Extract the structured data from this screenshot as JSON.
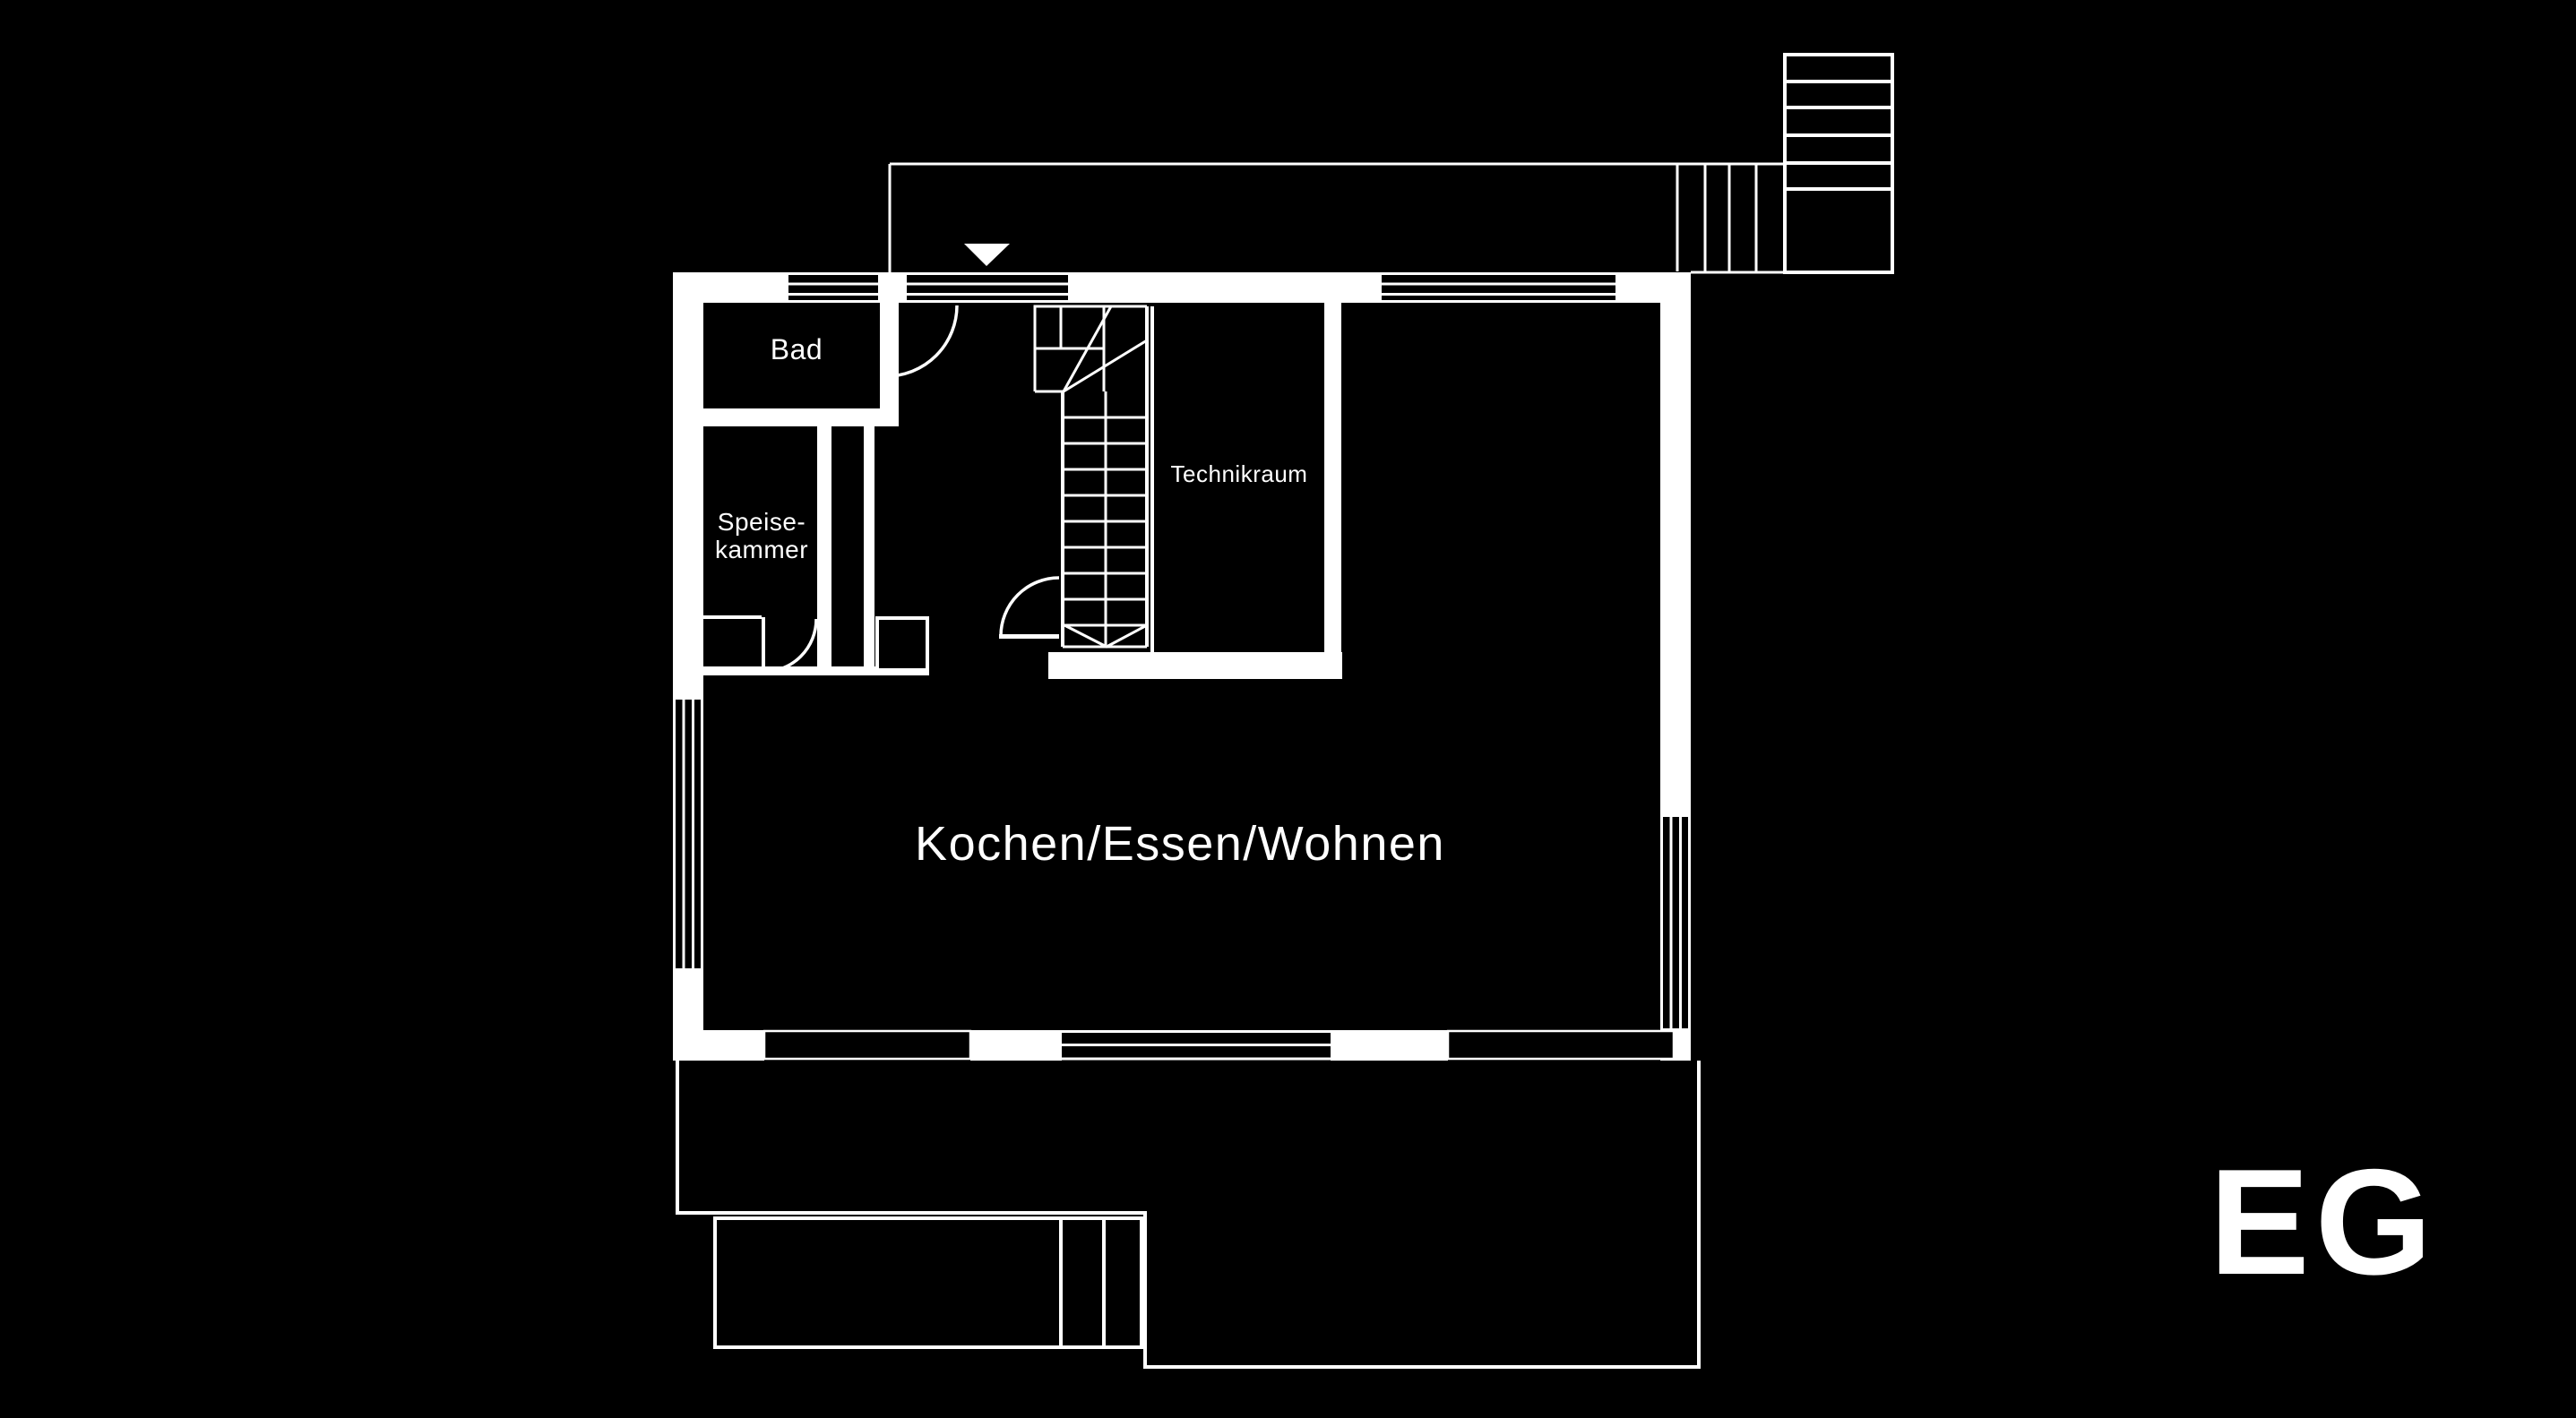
{
  "title": "EG",
  "floor": {
    "label": "EG"
  },
  "rooms": {
    "bad": {
      "label": "Bad"
    },
    "pantry": {
      "line1": "Speise-",
      "line2": "kammer"
    },
    "technik": {
      "label": "Technikraum"
    },
    "living": {
      "label": "Kochen/Essen/Wohnen"
    }
  },
  "icons": {
    "entrance_arrow": "triangle-down-icon"
  },
  "colors": {
    "background": "#000000",
    "lines": "#ffffff"
  }
}
